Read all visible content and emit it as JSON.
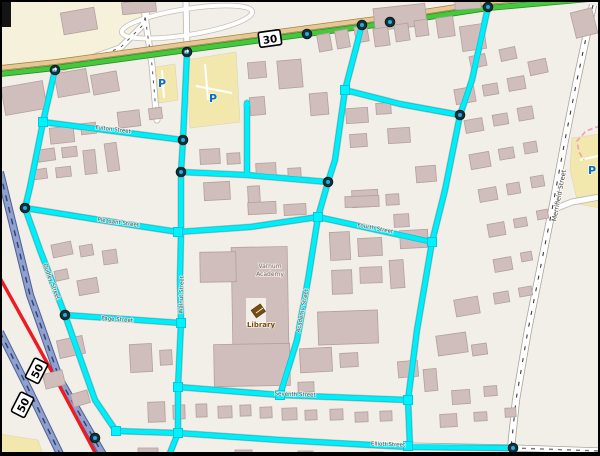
{
  "map": {
    "shields": [
      {
        "id": "route-30",
        "label": "30"
      },
      {
        "id": "route-50-a",
        "label": "50"
      },
      {
        "id": "route-50-b",
        "label": "50"
      }
    ],
    "street_labels": {
      "fulton": "Fulton Street",
      "pleasant": "Pleasant Street",
      "page": "Page Street",
      "walnut": "Walnut Street",
      "dudley": "Dudley Street",
      "fourth": "Fourth Street",
      "seventh": "Seventh Street",
      "elliott": "Elliott Street",
      "academy": "Academy Street",
      "merrifield": "Merrifield Street"
    },
    "pois": {
      "library": "Library",
      "academy_line1": "Varnum",
      "academy_line2": "Academy",
      "parking_symbol": "P"
    },
    "colors": {
      "land": "#f2efe9",
      "building": "#cfbebc",
      "building_outline": "#b3a09e",
      "route_highlight": "#00eef7",
      "route_square": "#00f2ff",
      "node_ring": "#123237",
      "node_core": "#2aa8df",
      "primary_green": "#46c83c",
      "secondary_tan": "#e6c897",
      "motorway_blue": "#8fa0cf",
      "motorway_red": "#ed1c24",
      "parking_yellow": "#f2e8ad",
      "retail_yellow": "#f6f1da",
      "parking_blue": "#0a6fc2",
      "poi_brown": "#7a4e10",
      "street_text": "#4a4a4a"
    }
  }
}
